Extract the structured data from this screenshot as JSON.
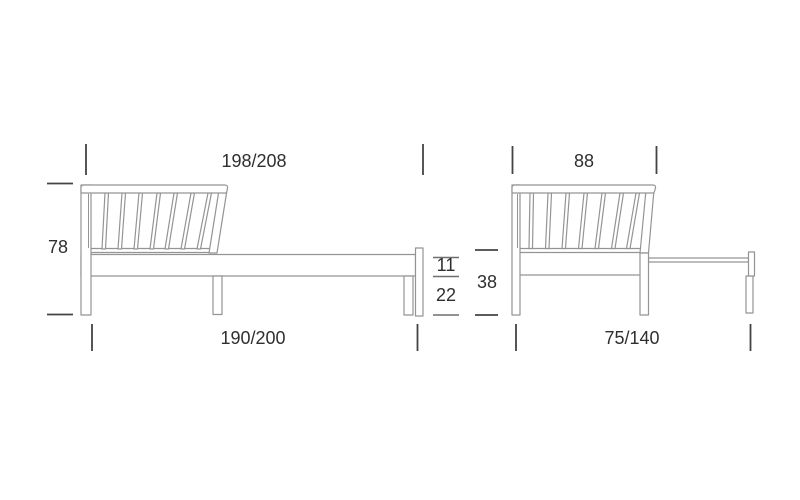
{
  "colors": {
    "background": "#ffffff",
    "outline": "#949494",
    "dimension": "#444444",
    "dimension_secondary": "#6f6f6f",
    "text": "#2f2f2f"
  },
  "side_view": {
    "overall_length": "198/208",
    "overall_height": "78",
    "frame_length": "190/200",
    "rail_height": "11",
    "under_clearance": "22"
  },
  "end_view": {
    "headboard_width": "88",
    "seat_height": "38",
    "frame_width": "75/140"
  }
}
